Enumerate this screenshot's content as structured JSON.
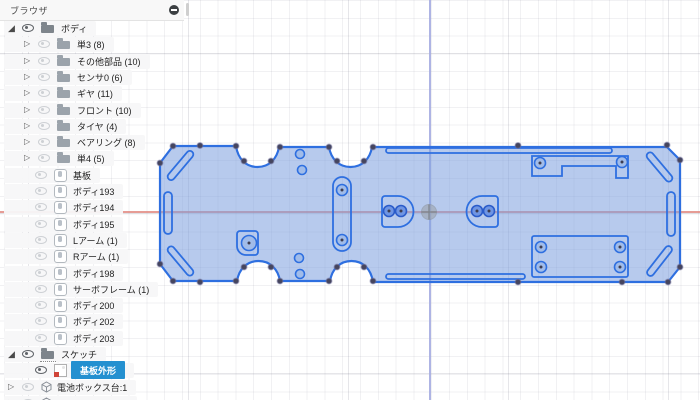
{
  "theme": {
    "selection_blue": "#2490d0",
    "sketch_stroke": "#2e6fe0",
    "sketch_fill": "rgba(124,158,222,0.55)",
    "hole_fill": "#6f95e3",
    "axis_x": "#e0837a",
    "axis_y": "#a5ace1",
    "vertex_dot": "#45455e"
  },
  "icons": {
    "expanded": "◢",
    "collapsed": "▷"
  },
  "browser": {
    "title": "ブラウザ",
    "items": [
      {
        "label": "ボディ",
        "type": "folder",
        "level": 0,
        "expanded": true,
        "visible": true
      },
      {
        "label": "単3 (8)",
        "type": "folder",
        "level": 1,
        "visible": false
      },
      {
        "label": "その他部品 (10)",
        "type": "folder",
        "level": 1,
        "visible": false
      },
      {
        "label": "センサ0 (6)",
        "type": "folder",
        "level": 1,
        "visible": false
      },
      {
        "label": "ギヤ (11)",
        "type": "folder",
        "level": 1,
        "visible": false
      },
      {
        "label": "フロント (10)",
        "type": "folder",
        "level": 1,
        "visible": false
      },
      {
        "label": "タイヤ (4)",
        "type": "folder",
        "level": 1,
        "visible": false
      },
      {
        "label": "ベアリング (8)",
        "type": "folder",
        "level": 1,
        "visible": false
      },
      {
        "label": "単4 (5)",
        "type": "folder",
        "level": 1,
        "visible": false
      },
      {
        "label": "基板",
        "type": "body",
        "level": 1,
        "visible": false
      },
      {
        "label": "ボディ193",
        "type": "body",
        "level": 1,
        "visible": false
      },
      {
        "label": "ボディ194",
        "type": "body",
        "level": 1,
        "visible": false
      },
      {
        "label": "ボディ195",
        "type": "body",
        "level": 1,
        "visible": false
      },
      {
        "label": "Lアーム (1)",
        "type": "body",
        "level": 1,
        "visible": false
      },
      {
        "label": "Rアーム (1)",
        "type": "body",
        "level": 1,
        "visible": false
      },
      {
        "label": "ボディ198",
        "type": "body",
        "level": 1,
        "visible": false
      },
      {
        "label": "サーボフレーム (1)",
        "type": "body",
        "level": 1,
        "visible": false
      },
      {
        "label": "ボディ200",
        "type": "body",
        "level": 1,
        "visible": false
      },
      {
        "label": "ボディ202",
        "type": "body",
        "level": 1,
        "visible": false
      },
      {
        "label": "ボディ203",
        "type": "body",
        "level": 1,
        "visible": false
      },
      {
        "label": "スケッチ",
        "type": "sketch-folder",
        "level": 0,
        "expanded": true,
        "visible": true
      },
      {
        "label": "基板外形",
        "type": "sketch",
        "level": 1,
        "selected": true,
        "visible": true
      },
      {
        "label": "電池ボックス台:1",
        "type": "component",
        "level": 0,
        "visible": false
      },
      {
        "label": "",
        "type": "component",
        "level": 0,
        "visible": false
      }
    ]
  }
}
